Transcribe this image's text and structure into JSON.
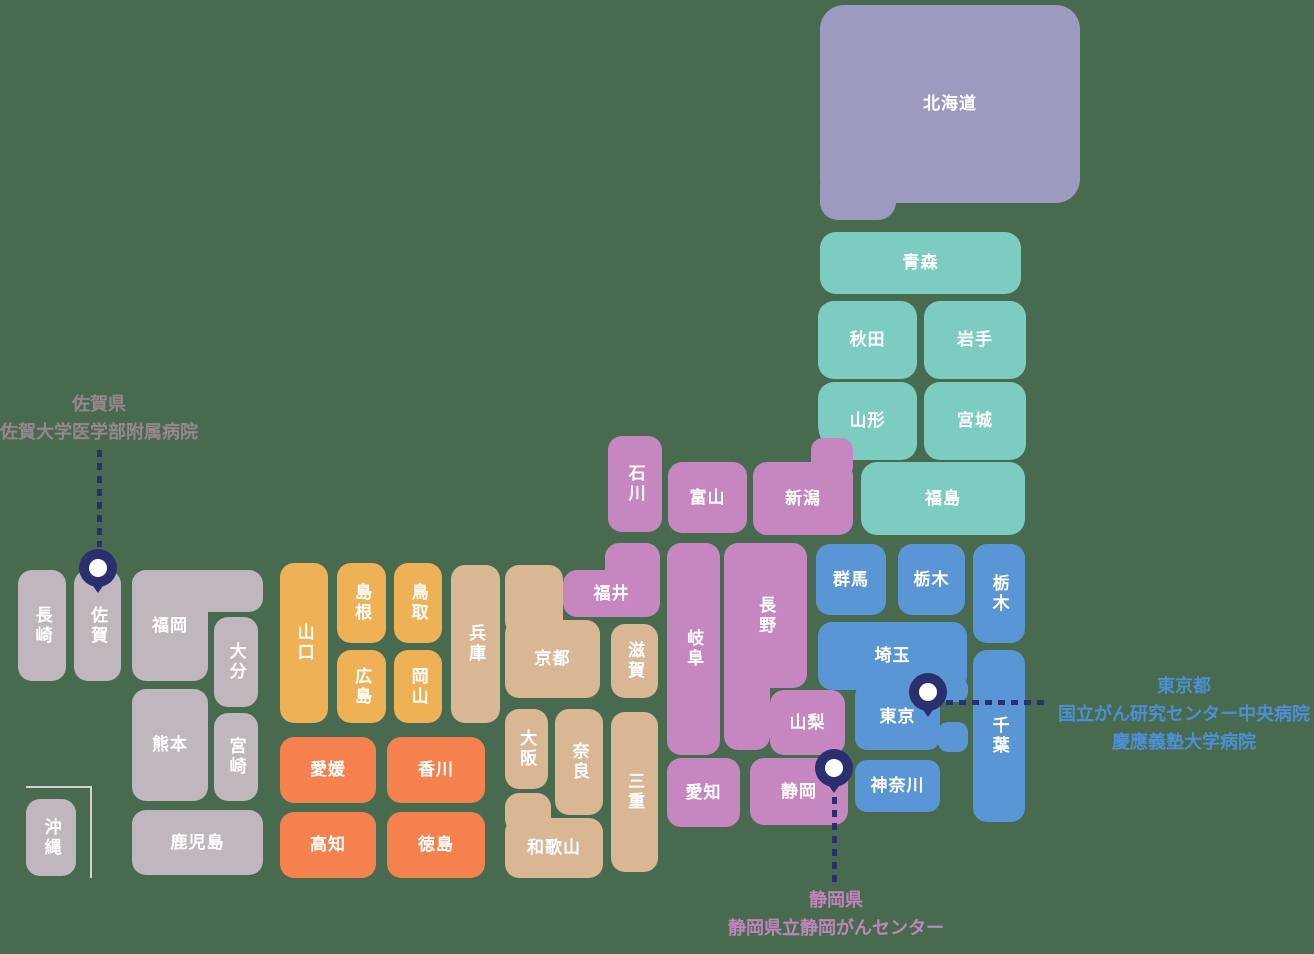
{
  "map": {
    "title": "Japan prefecture map with cancer-center hospital locations",
    "background_color": "#486B50",
    "label_color": "#FFFFFF",
    "pin_color": "#2A2F6E",
    "leader_color": "#2A2F6E",
    "region_colors": {
      "hokkaido": "#9D9ABF",
      "tohoku": "#7CCCC2",
      "chubu": "#C687C1",
      "kanto": "#5A95D6",
      "kansai": "#D9B795",
      "chugoku": "#EEB156",
      "shikoku": "#F5814E",
      "kyushu": "#BFB6BE"
    },
    "prefectures": [
      {
        "id": "hokkaido",
        "label": "北海道",
        "region": "hokkaido",
        "rect": [
          820,
          5,
          260,
          198
        ],
        "radius": 24,
        "vertical": false,
        "extras": [
          [
            820,
            168,
            76,
            52,
            18
          ]
        ]
      },
      {
        "id": "aomori",
        "label": "青森",
        "region": "tohoku",
        "rect": [
          820,
          232,
          201,
          62
        ],
        "radius": 16,
        "vertical": false
      },
      {
        "id": "akita",
        "label": "秋田",
        "region": "tohoku",
        "rect": [
          818,
          301,
          99,
          78
        ],
        "radius": 16,
        "vertical": false
      },
      {
        "id": "iwate",
        "label": "岩手",
        "region": "tohoku",
        "rect": [
          924,
          301,
          102,
          78
        ],
        "radius": 16,
        "vertical": false
      },
      {
        "id": "yamagata",
        "label": "山形",
        "region": "tohoku",
        "rect": [
          818,
          382,
          99,
          78
        ],
        "radius": 16,
        "radii": "16px 16px 16px 36px",
        "vertical": false
      },
      {
        "id": "miyagi",
        "label": "宮城",
        "region": "tohoku",
        "rect": [
          924,
          382,
          102,
          78
        ],
        "radius": 16,
        "vertical": false
      },
      {
        "id": "fukushima",
        "label": "福島",
        "region": "tohoku",
        "rect": [
          861,
          462,
          164,
          73
        ],
        "radius": 16,
        "vertical": false
      },
      {
        "id": "niigata",
        "label": "新潟",
        "region": "chubu",
        "rect": [
          753,
          462,
          100,
          73
        ],
        "radius": 14,
        "vertical": false,
        "extras": [
          [
            811,
            438,
            42,
            40,
            12
          ]
        ]
      },
      {
        "id": "ishikawa",
        "label": "石川",
        "region": "chubu",
        "rect": [
          608,
          436,
          54,
          96
        ],
        "radius": 14,
        "vertical": true
      },
      {
        "id": "toyama",
        "label": "富山",
        "region": "chubu",
        "rect": [
          668,
          462,
          79,
          71
        ],
        "radius": 14,
        "vertical": false
      },
      {
        "id": "fukui",
        "label": "福井",
        "region": "chubu",
        "rect": [
          563,
          570,
          97,
          47
        ],
        "radius": 14,
        "vertical": false,
        "extras": [
          [
            605,
            543,
            55,
            50,
            14
          ]
        ]
      },
      {
        "id": "gifu",
        "label": "岐阜",
        "region": "chubu",
        "rect": [
          667,
          543,
          53,
          212
        ],
        "radius": 14,
        "vertical": true
      },
      {
        "id": "nagano",
        "label": "長野",
        "region": "chubu",
        "rect": [
          724,
          543,
          83,
          145
        ],
        "radius": 14,
        "vertical": true,
        "extras": [
          [
            724,
            620,
            46,
            130,
            14
          ]
        ]
      },
      {
        "id": "yamanashi",
        "label": "山梨",
        "region": "chubu",
        "rect": [
          770,
          690,
          75,
          65
        ],
        "radius": 14,
        "vertical": false
      },
      {
        "id": "shizuoka",
        "label": "静岡",
        "region": "chubu",
        "rect": [
          750,
          758,
          98,
          67
        ],
        "radius": 14,
        "vertical": false
      },
      {
        "id": "aichi",
        "label": "愛知",
        "region": "chubu",
        "rect": [
          667,
          758,
          73,
          69
        ],
        "radius": 14,
        "vertical": false
      },
      {
        "id": "gunma",
        "label": "群馬",
        "region": "kanto",
        "rect": [
          816,
          544,
          70,
          71
        ],
        "radius": 14,
        "vertical": false
      },
      {
        "id": "tochigi",
        "label": "栃木",
        "region": "kanto",
        "rect": [
          898,
          544,
          67,
          71
        ],
        "radius": 14,
        "vertical": false
      },
      {
        "id": "tochigi-vertical",
        "label": "栃木",
        "region": "kanto",
        "rect": [
          973,
          544,
          52,
          99
        ],
        "radius": 14,
        "vertical": true
      },
      {
        "id": "saitama",
        "label": "埼玉",
        "region": "kanto",
        "rect": [
          818,
          622,
          149,
          68
        ],
        "radius": 14,
        "vertical": false
      },
      {
        "id": "tokyo",
        "label": "東京",
        "region": "kanto",
        "rect": [
          855,
          684,
          85,
          66
        ],
        "radius": 12,
        "vertical": false,
        "extras": [
          [
            938,
            678,
            30,
            24,
            10
          ],
          [
            938,
            722,
            30,
            30,
            10
          ]
        ]
      },
      {
        "id": "chiba",
        "label": "千葉",
        "region": "kanto",
        "rect": [
          973,
          650,
          52,
          172
        ],
        "radius": 14,
        "vertical": true
      },
      {
        "id": "kanagawa",
        "label": "神奈川",
        "region": "kanto",
        "rect": [
          855,
          760,
          85,
          52
        ],
        "radius": 12,
        "vertical": false
      },
      {
        "id": "hyogo",
        "label": "兵庫",
        "region": "kansai",
        "rect": [
          451,
          565,
          49,
          158
        ],
        "radius": 14,
        "vertical": true
      },
      {
        "id": "kyoto",
        "label": "京都",
        "region": "kansai",
        "rect": [
          505,
          620,
          95,
          78
        ],
        "radius": 14,
        "vertical": false,
        "extras": [
          [
            505,
            565,
            58,
            70,
            14
          ]
        ]
      },
      {
        "id": "shiga",
        "label": "滋賀",
        "region": "kansai",
        "rect": [
          611,
          624,
          47,
          74
        ],
        "radius": 14,
        "vertical": true
      },
      {
        "id": "osaka",
        "label": "大阪",
        "region": "kansai",
        "rect": [
          505,
          709,
          43,
          80
        ],
        "radius": 14,
        "vertical": true
      },
      {
        "id": "nara",
        "label": "奈良",
        "region": "kansai",
        "rect": [
          555,
          709,
          48,
          106
        ],
        "radius": 14,
        "vertical": true
      },
      {
        "id": "wakayama",
        "label": "和歌山",
        "region": "kansai",
        "rect": [
          505,
          818,
          98,
          60
        ],
        "radius": 14,
        "vertical": false,
        "extras": [
          [
            505,
            793,
            46,
            40,
            14
          ]
        ]
      },
      {
        "id": "mie",
        "label": "三重",
        "region": "kansai",
        "rect": [
          611,
          712,
          47,
          160
        ],
        "radius": 14,
        "vertical": true
      },
      {
        "id": "yamaguchi",
        "label": "山口",
        "region": "chugoku",
        "rect": [
          280,
          563,
          48,
          160
        ],
        "radius": 14,
        "vertical": true
      },
      {
        "id": "shimane",
        "label": "島根",
        "region": "chugoku",
        "rect": [
          337,
          563,
          49,
          80
        ],
        "radius": 14,
        "vertical": true
      },
      {
        "id": "tottori",
        "label": "鳥取",
        "region": "chugoku",
        "rect": [
          394,
          563,
          48,
          80
        ],
        "radius": 14,
        "vertical": true
      },
      {
        "id": "hiroshima",
        "label": "広島",
        "region": "chugoku",
        "rect": [
          337,
          650,
          49,
          73
        ],
        "radius": 14,
        "vertical": true
      },
      {
        "id": "okayama",
        "label": "岡山",
        "region": "chugoku",
        "rect": [
          394,
          650,
          48,
          73
        ],
        "radius": 14,
        "vertical": true
      },
      {
        "id": "ehime",
        "label": "愛媛",
        "region": "shikoku",
        "rect": [
          280,
          737,
          96,
          66
        ],
        "radius": 14,
        "vertical": false
      },
      {
        "id": "kagawa",
        "label": "香川",
        "region": "shikoku",
        "rect": [
          387,
          737,
          98,
          66
        ],
        "radius": 14,
        "vertical": false
      },
      {
        "id": "kochi",
        "label": "高知",
        "region": "shikoku",
        "rect": [
          280,
          812,
          96,
          66
        ],
        "radius": 14,
        "vertical": false
      },
      {
        "id": "tokushima",
        "label": "徳島",
        "region": "shikoku",
        "rect": [
          387,
          812,
          98,
          66
        ],
        "radius": 14,
        "vertical": false
      },
      {
        "id": "nagasaki",
        "label": "長崎",
        "region": "kyushu",
        "rect": [
          18,
          570,
          48,
          111
        ],
        "radius": 14,
        "vertical": true
      },
      {
        "id": "saga",
        "label": "佐賀",
        "region": "kyushu",
        "rect": [
          74,
          570,
          47,
          111
        ],
        "radius": 14,
        "vertical": true
      },
      {
        "id": "fukuoka",
        "label": "福岡",
        "region": "kyushu",
        "rect": [
          132,
          570,
          76,
          111
        ],
        "radius": 14,
        "vertical": false,
        "extras": [
          [
            132,
            570,
            131,
            42,
            14
          ]
        ]
      },
      {
        "id": "oita",
        "label": "大分",
        "region": "kyushu",
        "rect": [
          214,
          617,
          44,
          90
        ],
        "radius": 14,
        "vertical": true
      },
      {
        "id": "kumamoto",
        "label": "熊本",
        "region": "kyushu",
        "rect": [
          132,
          689,
          76,
          112
        ],
        "radius": 14,
        "vertical": false
      },
      {
        "id": "miyazaki",
        "label": "宮崎",
        "region": "kyushu",
        "rect": [
          214,
          713,
          44,
          88
        ],
        "radius": 14,
        "vertical": true
      },
      {
        "id": "kagoshima",
        "label": "鹿児島",
        "region": "kyushu",
        "rect": [
          132,
          810,
          131,
          65
        ],
        "radius": 14,
        "vertical": false
      },
      {
        "id": "okinawa",
        "label": "沖縄",
        "region": "kyushu",
        "rect": [
          26,
          799,
          50,
          77
        ],
        "radius": 14,
        "vertical": true
      }
    ],
    "inset_divider": {
      "x": 26,
      "y": 786,
      "w": 64,
      "h": 90,
      "color": "#D6D2D5",
      "thickness": 2
    },
    "pins": [
      {
        "id": "saga-pin",
        "cx": 98,
        "cy": 568
      },
      {
        "id": "tokyo-pin",
        "cx": 928,
        "cy": 692
      },
      {
        "id": "shizuoka-pin",
        "cx": 834,
        "cy": 768
      }
    ],
    "leaders": [
      {
        "id": "saga-leader",
        "dir": "v",
        "x": 97,
        "y": 450,
        "len": 97
      },
      {
        "id": "tokyo-leader",
        "dir": "h",
        "x": 946,
        "y": 700,
        "len": 100
      },
      {
        "id": "shizuoka-leader",
        "dir": "v",
        "x": 832,
        "y": 797,
        "len": 89
      }
    ],
    "annotations": [
      {
        "id": "saga",
        "color": "#96868F",
        "cx": 99,
        "top": 390,
        "lines": [
          "佐賀県",
          "佐賀大学医学部附属病院"
        ]
      },
      {
        "id": "tokyo",
        "color": "#4C8FD5",
        "cx": 1184,
        "top": 672,
        "lines": [
          "東京都",
          "国立がん研究センター中央病院",
          "慶應義塾大学病院"
        ]
      },
      {
        "id": "shizuoka",
        "color": "#BF85BA",
        "cx": 836,
        "top": 886,
        "lines": [
          "静岡県",
          "静岡県立静岡がんセンター"
        ]
      }
    ]
  }
}
